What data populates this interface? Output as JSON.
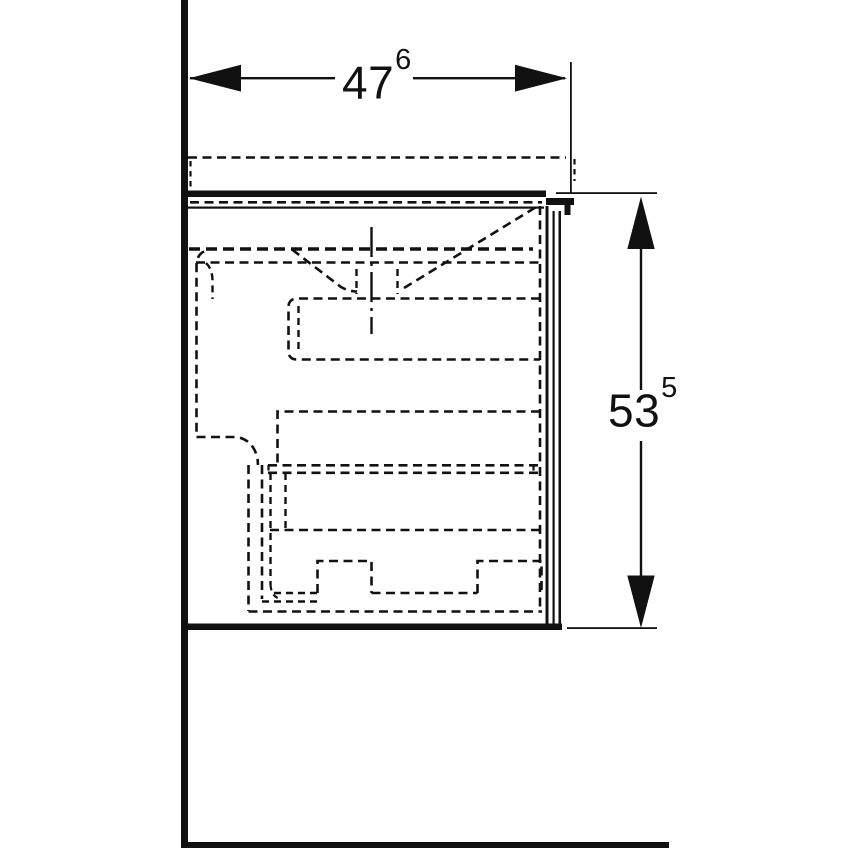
{
  "drawing": {
    "kind": "technical-dimension-drawing-side-view",
    "colors": {
      "line": "#111111",
      "background": "#ffffff"
    },
    "dimensions": {
      "width": {
        "value": "47",
        "superscript": "6"
      },
      "height": {
        "value": "53",
        "superscript": "5"
      }
    },
    "icons": {
      "width_arrows": [
        "arrowhead-left-icon",
        "arrowhead-right-icon"
      ],
      "height_arrows": [
        "arrowhead-up-icon",
        "arrowhead-down-icon"
      ]
    }
  }
}
